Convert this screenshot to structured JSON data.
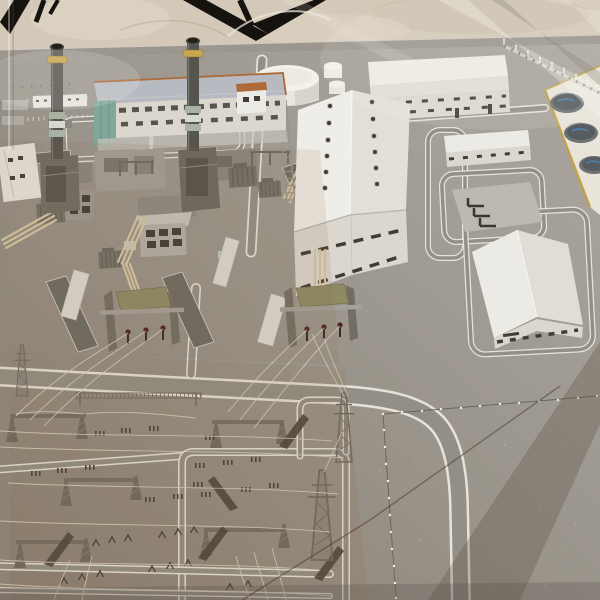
{
  "scene": {
    "type": "photograph",
    "description": "Architectural scale model of a gas-fired power plant with twin exhaust stacks, turbine hall, warehouses, storage tanks and a high-voltage switchyard, displayed under a glass case with visible reflections",
    "setting": "indoor exhibition display; dark camera cables hang above the glass cover; beige wall behind",
    "objects": [
      {
        "name": "background-wall",
        "label": "Beige wall behind the display case"
      },
      {
        "name": "camera-cables",
        "label": "Dark cables and tripod legs above the case"
      },
      {
        "name": "display-case-frame",
        "label": "Grey edge bar of the glass display case"
      },
      {
        "name": "model-ground",
        "label": "Grey model baseplate"
      },
      {
        "name": "road-network",
        "label": "Internal roads with white edge lines and rounded loops"
      },
      {
        "name": "parking-lot",
        "label": "Striped parking area near the powerhouse"
      },
      {
        "name": "powerhouse-building",
        "label": "Main powerhouse, blue-grey roof with orange trim and teal stair tower"
      },
      {
        "name": "exhaust-stack-left",
        "label": "Tall exhaust stack with yellow collar and green base bands"
      },
      {
        "name": "exhaust-stack-right",
        "label": "Tall exhaust stack with yellow collar and green base bands"
      },
      {
        "name": "water-tank",
        "label": "Large white cylindrical storage tank"
      },
      {
        "name": "small-tanks",
        "label": "Two small white cylindrical tanks"
      },
      {
        "name": "turbine-hall",
        "label": "Large white hall with twin rows of roof vents and louvred walls"
      },
      {
        "name": "long-warehouse",
        "label": "Long white warehouse with louvred windows"
      },
      {
        "name": "small-office",
        "label": "Flat-roof auxiliary building"
      },
      {
        "name": "pipe-pad",
        "label": "Concrete pad with dark pipe stubs"
      },
      {
        "name": "gabled-warehouse",
        "label": "Gabled white warehouse"
      },
      {
        "name": "fuel-tank-farm",
        "label": "Three dark circular tanks on a white pad with yellow kerb"
      },
      {
        "name": "equipment-yard",
        "label": "Auxiliary equipment: transformers, containers, cream pipe bridges"
      },
      {
        "name": "transformer-bay-left",
        "label": "Step-up transformer bay with khaki cover and brown bushings"
      },
      {
        "name": "transformer-bay-center",
        "label": "Step-up transformer bay with khaki cover and brown bushings"
      },
      {
        "name": "switchyard",
        "label": "High-voltage switchyard: lattice gantries, busbars, insulators, wires"
      },
      {
        "name": "transmission-towers",
        "label": "Lattice transmission towers"
      },
      {
        "name": "perimeter-fence",
        "label": "Perimeter fence posts along the top right"
      },
      {
        "name": "lot-fence",
        "label": "L-shaped fence line with white post tops around the empty lot"
      },
      {
        "name": "glass-reflections",
        "label": "Diagonal light streaks and dark shadow band on the glass"
      }
    ]
  },
  "colors": {
    "wall_bg": "#d4c9b7",
    "case_frame": "#9b968e",
    "ground_light": "#aba7a0",
    "ground_mid": "#9c978e",
    "ground_warm": "#8a7f71",
    "road_line": "#e7e3d9",
    "road_fill": "#938f87",
    "asphalt_dark": "#6e6a62",
    "building_white": "#eceae4",
    "building_wall": "#dbd7cf",
    "building_shade": "#c7c3bb",
    "window_dark": "#403d37",
    "roof_bluegray": "#b7bbc1",
    "trim_orange": "#b06a35",
    "glass_teal": "#7fa79a",
    "stack_gray": "#56544e",
    "stack_ring": "#c9a64e",
    "stack_green": "#a9b2a3",
    "tank_white": "#f3f1ec",
    "tankfarm_pad": "#e9e4d9",
    "pad_yellow": "#c3a23f",
    "tank_dark": "#565c60",
    "tank_blue": "#4e7da3",
    "equip_gray": "#757067",
    "container_white": "#dcd9d2",
    "pipe_cream": "#d6c7a0",
    "bay_khaki": "#8f8a62",
    "bushing_brown": "#50231c",
    "lattice_gray": "#6e695f",
    "wire_light": "#ddd5c3",
    "fence_white": "#e8e4db",
    "cable_black": "#16120e"
  }
}
